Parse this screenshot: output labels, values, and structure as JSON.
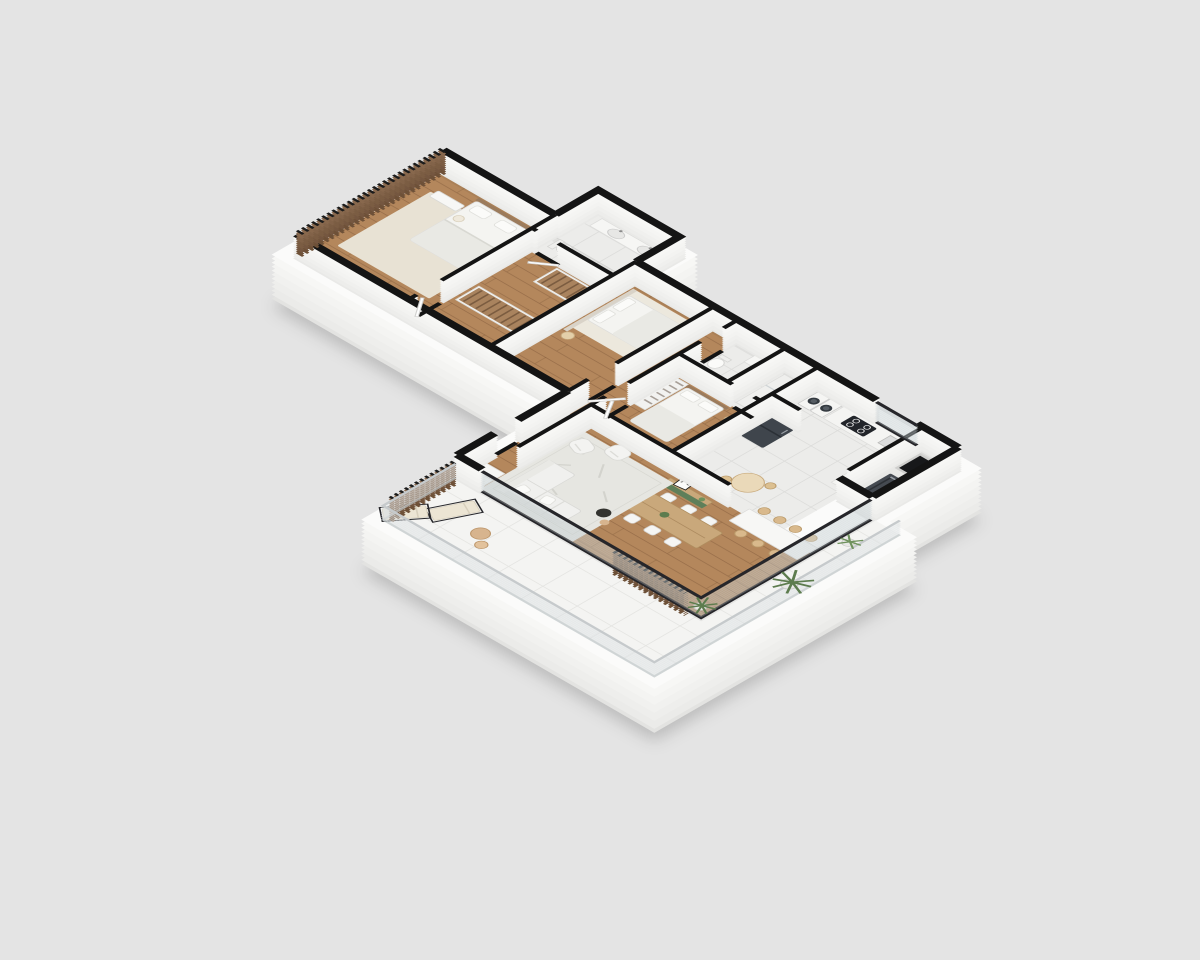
{
  "scene": {
    "type": "isometric-3d-floor-plan",
    "description": "Rendered 3D cutaway floor plan of an apartment viewed isometrically from above, sitting on a white plinth over a plain gray backdrop",
    "background": "#e4e4e4"
  },
  "palette": {
    "background": "#e4e4e4",
    "plinth_top": "#fbfbfa",
    "plinth_side": "#ebebe9",
    "wall_side": "#f3f3f1",
    "wall_top": "#141414",
    "wood_floor": "#b4875c",
    "tile_floor": "#ececea",
    "terrace_floor": "#f4f4f2",
    "rug_cream": "#e8e2d4",
    "rug_living": "#e6e6e1",
    "linen": "#f4f4f1",
    "blanket": "#e9e9e4",
    "green_accent": "#7d9a6f",
    "green_cabinet": "#5f7f5a",
    "wood_furniture": "#c9a87b",
    "stool_wood": "#d9b98c",
    "wardrobe_wood": "#a9835e",
    "slat_screen": "#7b5d43",
    "appliance_dark": "#3f454c",
    "glass_frame": "#26262a",
    "plant_green": "#5d7c4e",
    "pot": "#e9e9e7",
    "lounger_cushion": "#ece5d4",
    "sand_wood": "#d7b48e"
  },
  "rooms": [
    {
      "id": "master-bedroom",
      "furniture": [
        "double-bed",
        "area-rug",
        "bench",
        "ottoman",
        "slatted-screen-wall"
      ]
    },
    {
      "id": "walk-in-closet",
      "furniture": [
        "wardrobe-row-a",
        "wardrobe-row-b"
      ]
    },
    {
      "id": "master-bathroom",
      "furniture": [
        "double-sink-vanity",
        "toilet"
      ]
    },
    {
      "id": "bedroom-2",
      "furniture": [
        "double-bed",
        "green-bench",
        "rug",
        "round-side-table",
        "panel-headboard"
      ]
    },
    {
      "id": "hallway",
      "furniture": []
    },
    {
      "id": "bathroom-2",
      "furniture": [
        "vanity-sink",
        "toilet"
      ]
    },
    {
      "id": "shower-room",
      "furniture": [
        "shower-tray"
      ]
    },
    {
      "id": "bedroom-3",
      "furniture": [
        "double-bed",
        "open-wardrobe"
      ]
    },
    {
      "id": "laundry",
      "furniture": [
        "washer",
        "dryer"
      ]
    },
    {
      "id": "kitchen",
      "furniture": [
        "counter",
        "cooktop",
        "sink",
        "oven-cabinet",
        "refrigerator",
        "breakfast-table",
        "stools"
      ]
    },
    {
      "id": "service-area",
      "furniture": [
        "shaft",
        "grill-unit"
      ]
    },
    {
      "id": "entry",
      "furniture": [
        "console-cabinet"
      ]
    },
    {
      "id": "living-room",
      "furniture": [
        "sectional-sofa",
        "armchair-a",
        "armchair-b",
        "area-rug",
        "coffee-table",
        "side-table",
        "floor-plant"
      ]
    },
    {
      "id": "dining-area",
      "furniture": [
        "dining-table",
        "dining-chairs",
        "island-high-table",
        "bar-stools",
        "green-sideboard",
        "leaning-art-frame"
      ]
    },
    {
      "id": "balcony-terrace",
      "furniture": [
        "sun-lounger-a",
        "sun-lounger-b",
        "round-side-tables",
        "potted-plants",
        "glass-railing",
        "slatted-privacy-screens"
      ]
    }
  ]
}
